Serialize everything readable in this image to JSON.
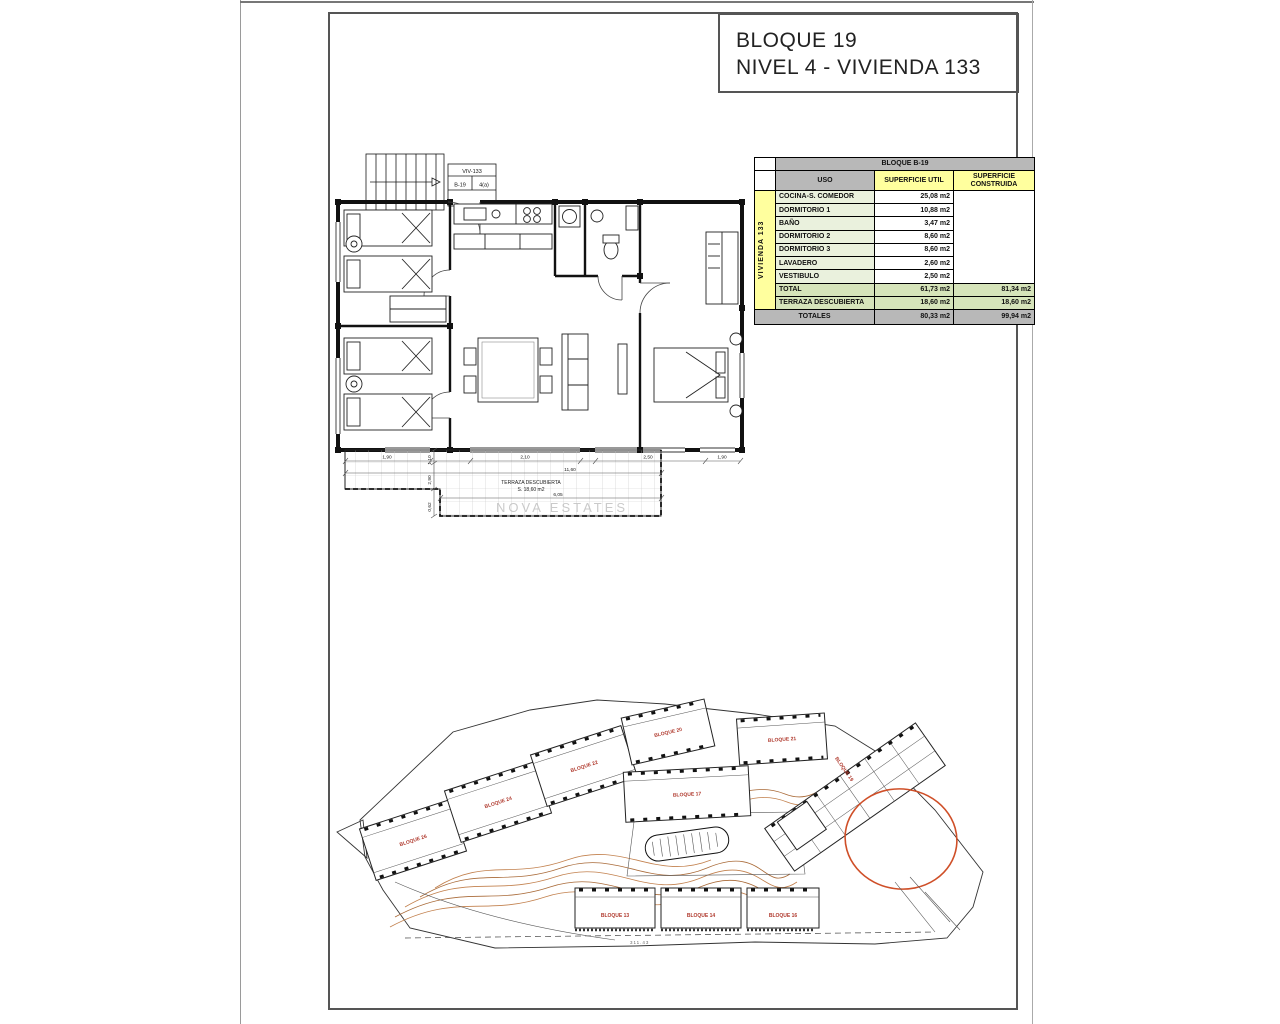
{
  "title_block": {
    "line1": "BLOQUE 19",
    "line2": "NIVEL 4 - VIVIENDA 133"
  },
  "unit_tag": {
    "title": "VIV-133",
    "cell1": "B-19",
    "cell2": "4(a)",
    "area": "80,33"
  },
  "areas_table": {
    "block_header": "BLOQUE B-19",
    "headers": {
      "uso": "USO",
      "util": "SUPERFICIE UTIL",
      "constr": "SUPERFICIE CONSTRUIDA"
    },
    "unit_label": "VIVIENDA 133",
    "rows": [
      {
        "uso": "COCINA-S. COMEDOR",
        "util": "25,08 m2"
      },
      {
        "uso": "DORMITORIO 1",
        "util": "10,88 m2"
      },
      {
        "uso": "BAÑO",
        "util": "3,47 m2"
      },
      {
        "uso": "DORMITORIO 2",
        "util": "8,60 m2"
      },
      {
        "uso": "DORMITORIO 3",
        "util": "8,60 m2"
      },
      {
        "uso": "LAVADERO",
        "util": "2,60 m2"
      },
      {
        "uso": "VESTIBULO",
        "util": "2,50 m2"
      }
    ],
    "total_row": {
      "label": "TOTAL",
      "util": "61,73 m2",
      "constr": "81,34 m2"
    },
    "terraza_row": {
      "label": "TERRAZA DESCUBIERTA",
      "util": "18,60 m2",
      "constr": "18,60 m2"
    },
    "totales_row": {
      "label": "TOTALES",
      "util": "80,33 m2",
      "constr": "99,94 m2"
    }
  },
  "floor_plan": {
    "terrace_label": "TERRAZA DESCUBIERTA",
    "terrace_area": "S. 18,60 m2",
    "dim_top": [
      "1,90",
      "2,10",
      "2,50",
      "1,90"
    ],
    "dim_total": "11,60",
    "dim_bottom": "6,05",
    "dim_left": [
      "1,10",
      "2,90",
      "0,62"
    ]
  },
  "site_plan": {
    "labels": [
      "BLOQUE 26",
      "BLOQUE 24",
      "BLOQUE 22",
      "BLOQUE 20",
      "BLOQUE 21",
      "BLOQUE 17",
      "BLOQUE 19",
      "BLOQUE 13",
      "BLOQUE 14",
      "BLOQUE 16"
    ],
    "elevation": "311.43"
  },
  "watermark": "NOVA ESTATES",
  "colors": {
    "highlight_red": "#e8000d",
    "highlight_circle": "#cf4f28",
    "block_label_red": "#b03a2e",
    "table_gray": "#b8b8b8",
    "table_yellow": "#ffff9e",
    "table_green_light": "#eaf1dd",
    "table_green": "#d6e4ba",
    "contour_orange": "#c2804d"
  }
}
